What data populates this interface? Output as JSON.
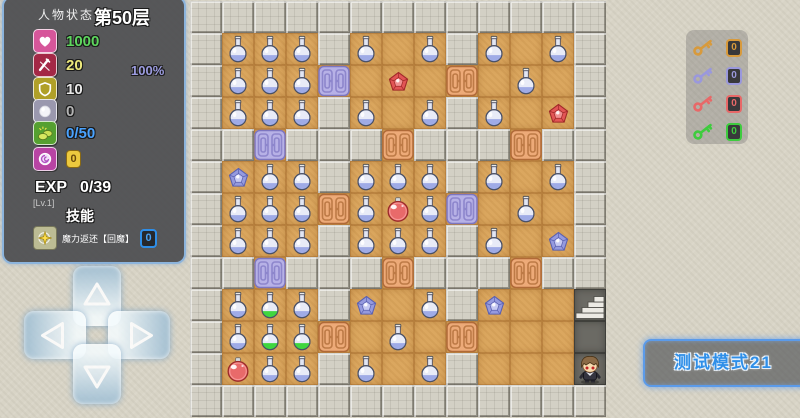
{
  "hud": {
    "panel_title": "人物状态",
    "floor_label": "第50层",
    "hp_percent": "100%",
    "stats": [
      {
        "name": "hp",
        "icon": "heart-icon",
        "value": "1000",
        "color": "#5ed65e",
        "bg": "#d6569a"
      },
      {
        "name": "attack",
        "icon": "sword-icon",
        "value": "20",
        "color": "#ece87c",
        "bg": "#a42846"
      },
      {
        "name": "defense",
        "icon": "shield-icon",
        "value": "10",
        "color": "#e8e8e8",
        "bg": "#b0a028"
      },
      {
        "name": "magic-defense",
        "icon": "orb-icon",
        "value": "0",
        "color": "#b4b4b4",
        "bg": "#9a98ae"
      },
      {
        "name": "gold",
        "icon": "coins-icon",
        "value": "0/50",
        "color": "#4aa3ff",
        "bg": "#55a030"
      },
      {
        "name": "magic-coin",
        "icon": "spiral-coin-icon",
        "value": "0",
        "color": "#6a4a0a",
        "bg": "#b844a4",
        "badge": true
      }
    ],
    "exp_label": "EXP",
    "exp_value": "0/39",
    "level_label": "[Lv.1]",
    "skills_heading": "技能",
    "skill": {
      "name": "魔力返还【回魔】",
      "count": "0"
    }
  },
  "keys": [
    {
      "name": "yellow-key",
      "color": "#d89a3c",
      "count": "0"
    },
    {
      "name": "blue-key",
      "color": "#9a98dc",
      "count": "0"
    },
    {
      "name": "red-key",
      "color": "#e86868",
      "count": "0"
    },
    {
      "name": "green-key",
      "color": "#3ecc3e",
      "count": "0"
    }
  ],
  "test_mode_label": "测试模式21",
  "palette": {
    "floor": "#dba75f",
    "wall": "#d3d0c5",
    "orange_door": "#edaa78",
    "purple_door": "#b7b1e6",
    "blue_potion": "#9fabe6",
    "green_potion": "#3fd63f",
    "red_potion": "#e86a6a",
    "red_gem": "#e25555",
    "blue_gem": "#959ade",
    "accent_blue": "#2f8fe8"
  },
  "map": {
    "tile_size": 32,
    "columns": 13,
    "rows_count": 13,
    "legend": {
      "#": "wall",
      ".": "floor",
      "d": "dark-floor",
      "p": "blue-potion",
      "g": "green-potion",
      "r": "red-potion",
      "R": "red-gem",
      "B": "blue-gem",
      "O": "orange-door",
      "P": "purple-door",
      "S": "stairs-up",
      "H": "hero"
    },
    "rows": [
      "#############",
      "#ppp#p.p#p.p#",
      "#pppP.R.O.p.#",
      "#ppp#p.p#p.R#",
      "##P###O###O##",
      "#Bpp#ppp#p.p#",
      "#pppOprpP.p.#",
      "#ppp#ppp#p.B#",
      "##P###O###O##",
      "#pgp#B.p#B..S",
      "#pggO.p.O...d",
      "#rpp#p.p#...H",
      "#############"
    ]
  },
  "dpad": [
    {
      "dir": "up"
    },
    {
      "dir": "left"
    },
    {
      "dir": "right"
    },
    {
      "dir": "down"
    }
  ]
}
